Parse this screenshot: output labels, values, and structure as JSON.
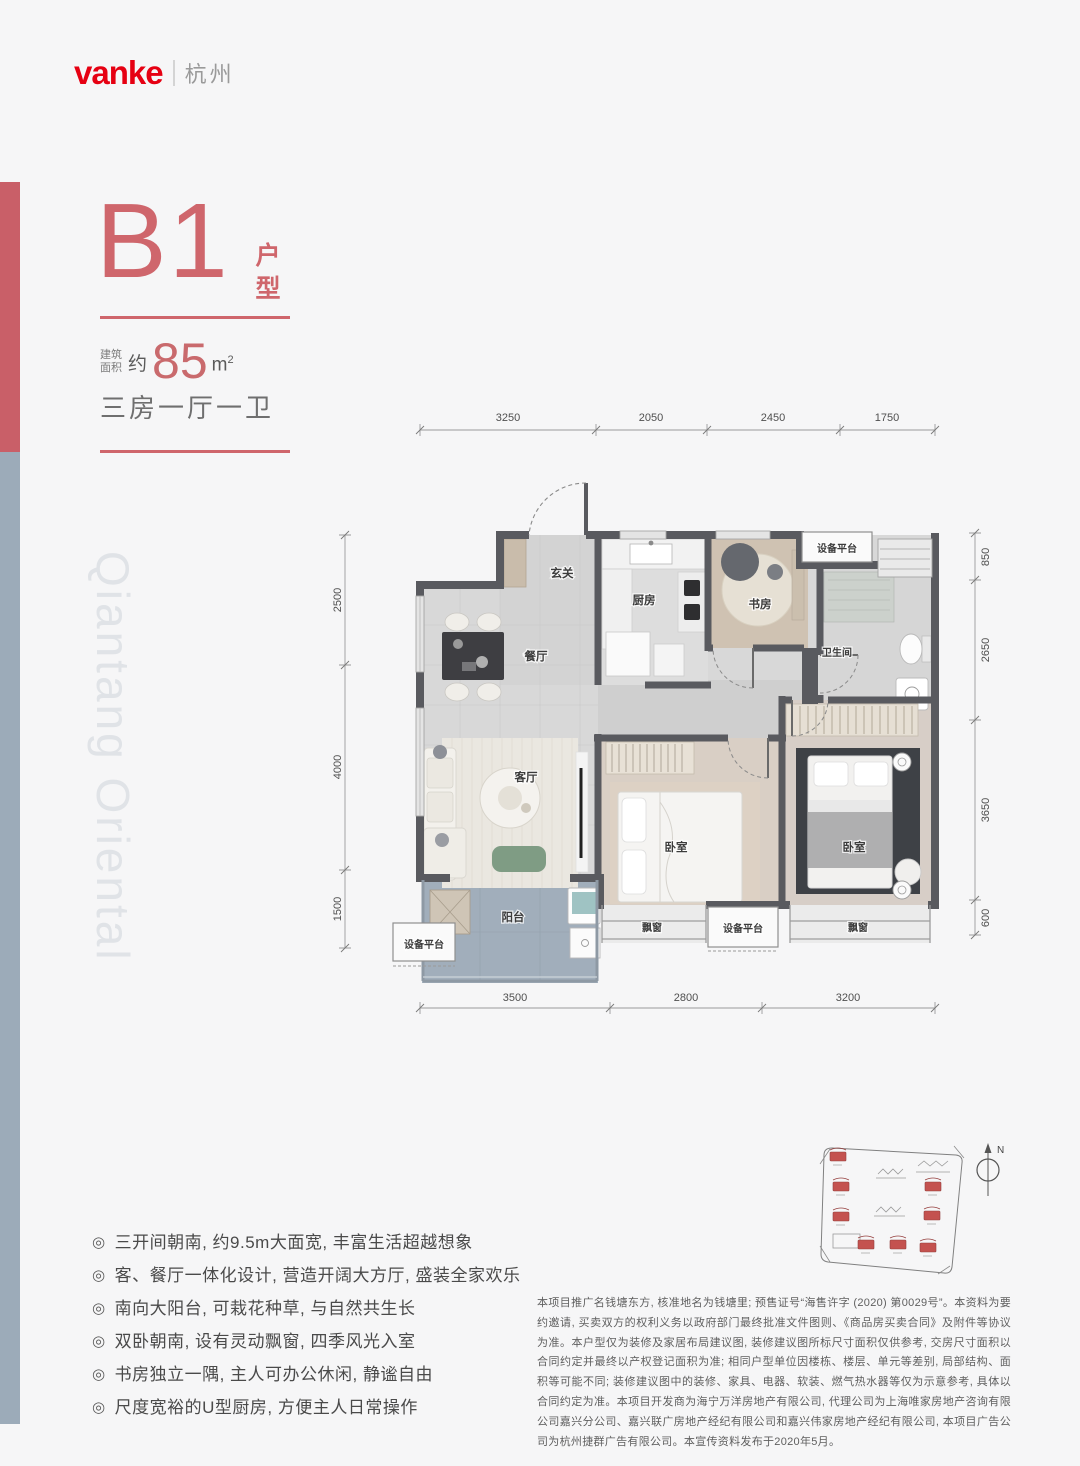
{
  "brand": {
    "logo": "vanke",
    "city": "杭州"
  },
  "unit": {
    "name": "B1",
    "name_suffix": "户型",
    "area_prefix_line1": "建筑",
    "area_prefix_line2": "面积",
    "area_approx": "约",
    "area_value": "85",
    "area_unit": "m",
    "area_unit_sup": "2",
    "layout": "三房一厅一卫"
  },
  "watermark": "Qiantang Oriental",
  "plan": {
    "rooms": {
      "entry": "玄关",
      "kitchen": "厨房",
      "study": "书房",
      "dining": "餐厅",
      "bath": "卫生间",
      "living": "客厅",
      "bedroom1": "卧室",
      "bedroom2": "卧室",
      "balcony": "阳台",
      "equip_tr": "设备平台",
      "equip_bm": "设备平台",
      "equip_bl": "设备平台",
      "bay1": "飘窗",
      "bay2": "飘窗"
    },
    "dims": {
      "top": [
        "3250",
        "2050",
        "2450",
        "1750"
      ],
      "bottom": [
        "3500",
        "2800",
        "3200"
      ],
      "left": [
        "2500",
        "4000",
        "1500"
      ],
      "right": [
        "850",
        "2650",
        "3650",
        "600"
      ]
    },
    "compass_n": "N"
  },
  "features": {
    "bullet": "◎",
    "items": [
      "三开间朝南, 约9.5m大面宽, 丰富生活超越想象",
      "客、餐厅一体化设计, 营造开阔大方厅, 盛装全家欢乐",
      "南向大阳台, 可栽花种草, 与自然共生长",
      "双卧朝南, 设有灵动飘窗, 四季风光入室",
      "书房独立一隅, 主人可办公休闲, 静谧自由",
      "尺度宽裕的U型厨房, 方便主人日常操作"
    ]
  },
  "disclaimer": "本项目推广名钱塘东方, 核准地名为钱塘里; 预售证号“海售许字 (2020) 第0029号”。本资料为要约邀请, 买卖双方的权利义务以政府部门最终批准文件图则、《商品房买卖合同》及附件等协议为准。本户型仅为装修及家居布局建议图, 装修建议图所标尺寸面积仅供参考, 交房尺寸面积以合同约定并最终以产权登记面积为准; 相同户型单位因楼栋、楼层、单元等差别, 局部结构、面积等可能不同; 装修建议图中的装修、家具、电器、软装、燃气热水器等仅为示意参考, 具体以合同约定为准。本项目开发商为海宁万洋房地产有限公司, 代理公司为上海唯家房地产咨询有限公司嘉兴分公司、嘉兴联广房地产经纪有限公司和嘉兴伟家房地产经纪有限公司, 本项目广告公司为杭州捷群广告有限公司。本宣传资料发布于2020年5月。",
  "colors": {
    "accent_red": "#e60012",
    "soft_red": "#cf666c",
    "bar_blue": "#9cabb9",
    "wall": "#595a5f"
  }
}
